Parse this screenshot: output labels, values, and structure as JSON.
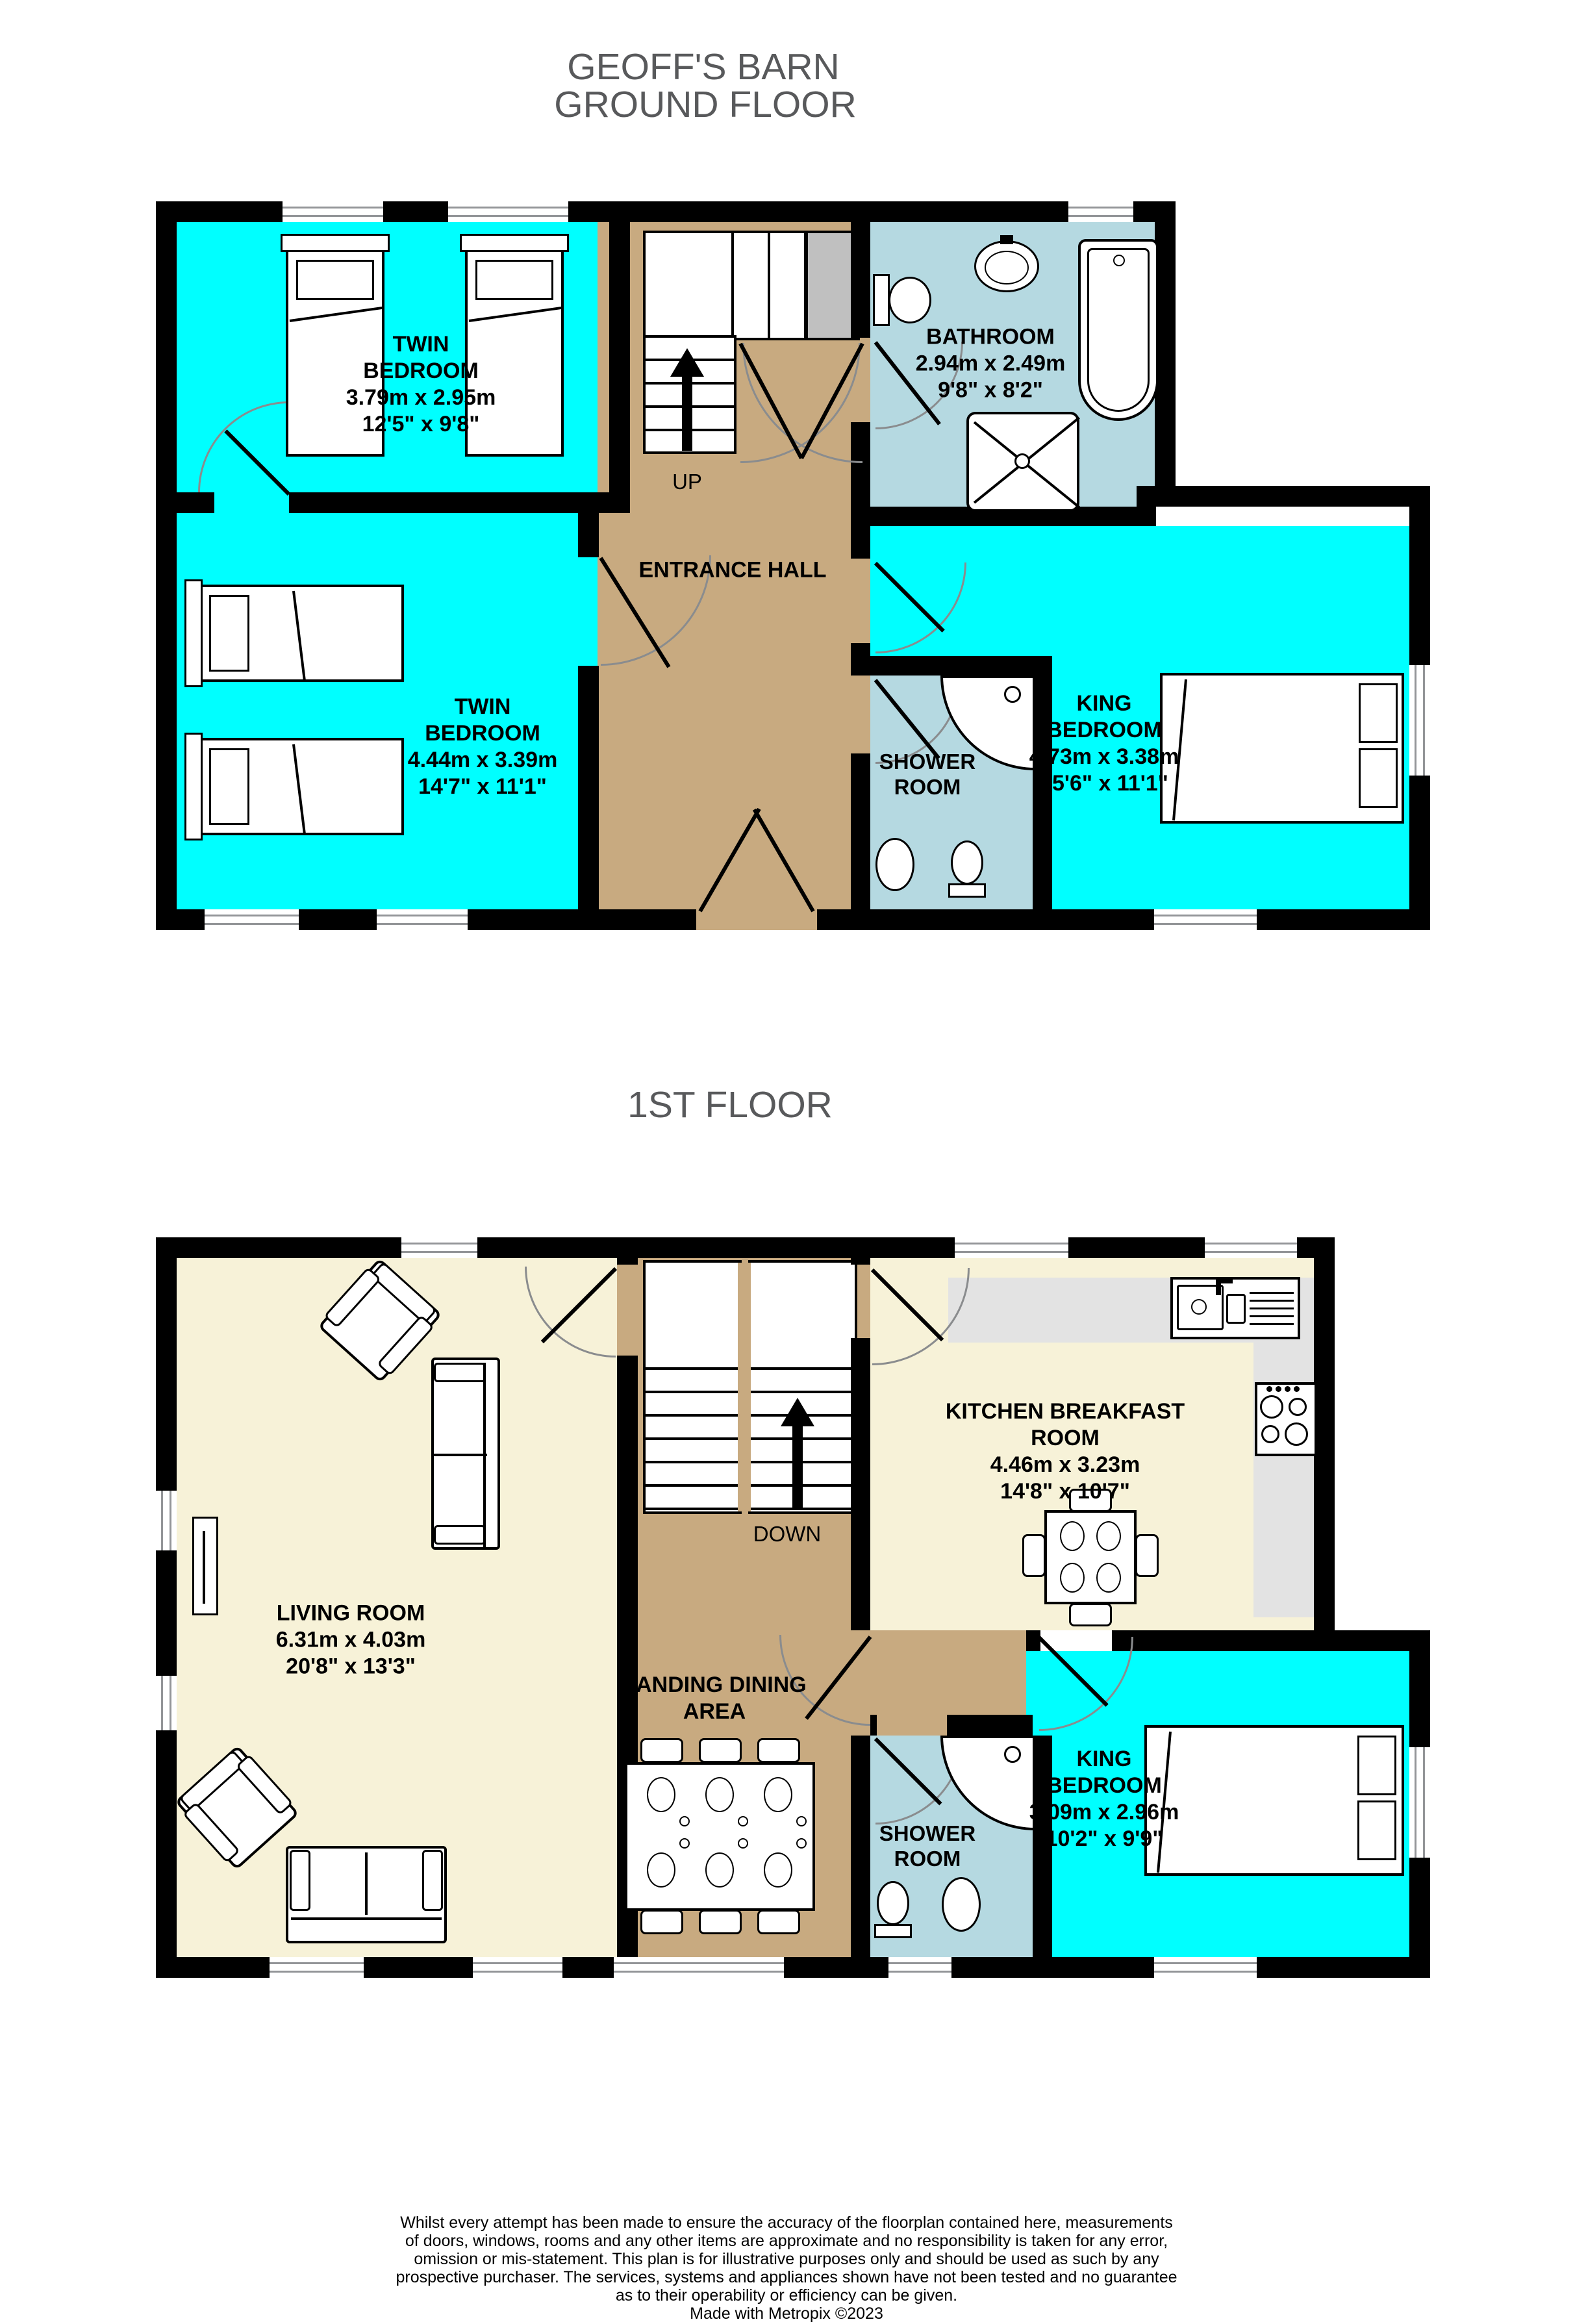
{
  "header": {
    "line1": "GEOFF'S BARN",
    "line2": "GROUND FLOOR"
  },
  "first_floor_title": "1ST FLOOR",
  "colors": {
    "room_cyan": "#00FFFF",
    "bath_blue": "#B5D9E1",
    "hall_tan": "#C8AA80",
    "living_cream": "#F7F2D8",
    "counter_gray": "#E3E3E3",
    "cupboard_gray": "#C0C0C0",
    "wall_black": "#000000",
    "title_gray": "#58595B"
  },
  "ground_floor": {
    "stairs_label": "UP",
    "rooms": {
      "twin_bedroom_1": {
        "name": "TWIN BEDROOM",
        "dim_m": "3.79m  x 2.95m",
        "dim_ft": "12'5\"  x 9'8\""
      },
      "bathroom": {
        "name": "BATHROOM",
        "dim_m": "2.94m  x 2.49m",
        "dim_ft": "9'8\"  x 8'2\""
      },
      "twin_bedroom_2": {
        "name": "TWIN BEDROOM",
        "dim_m": "4.44m  x 3.39m",
        "dim_ft": "14'7\"  x 11'1\""
      },
      "entrance_hall": {
        "name": "ENTRANCE HALL"
      },
      "shower_room": {
        "name": "SHOWER ROOM"
      },
      "king_bedroom": {
        "name": "KING BEDROOM",
        "dim_m": "4.73m  x 3.38m",
        "dim_ft": "15'6\"  x 11'1\""
      }
    }
  },
  "first_floor": {
    "stairs_label": "DOWN",
    "rooms": {
      "living_room": {
        "name": "LIVING ROOM",
        "dim_m": "6.31m  x 4.03m",
        "dim_ft": "20'8\"  x 13'3\""
      },
      "kitchen_breakfast_room": {
        "name": "KITCHEN BREAKFAST ROOM",
        "dim_m": "4.46m  x 3.23m",
        "dim_ft": "14'8\"  x 10'7\""
      },
      "landing_dining_area": {
        "name": "LANDING DINING AREA"
      },
      "shower_room": {
        "name": "SHOWER ROOM"
      },
      "king_bedroom": {
        "name": "KING BEDROOM",
        "dim_m": "3.09m  x 2.96m",
        "dim_ft": "10'2\"  x 9'9\""
      }
    }
  },
  "footer": {
    "disclaimer_lines": [
      "Whilst every attempt has been made to ensure the accuracy of the floorplan contained here, measurements",
      "of doors, windows, rooms and any other items are approximate and no responsibility is taken for any error,",
      "omission or mis-statement. This plan is for illustrative purposes only and should be used as such by any",
      "prospective purchaser. The services, systems and appliances shown have not been tested and no guarantee",
      "as to their operability or efficiency can be given.",
      "Made with Metropix ©2023"
    ]
  }
}
